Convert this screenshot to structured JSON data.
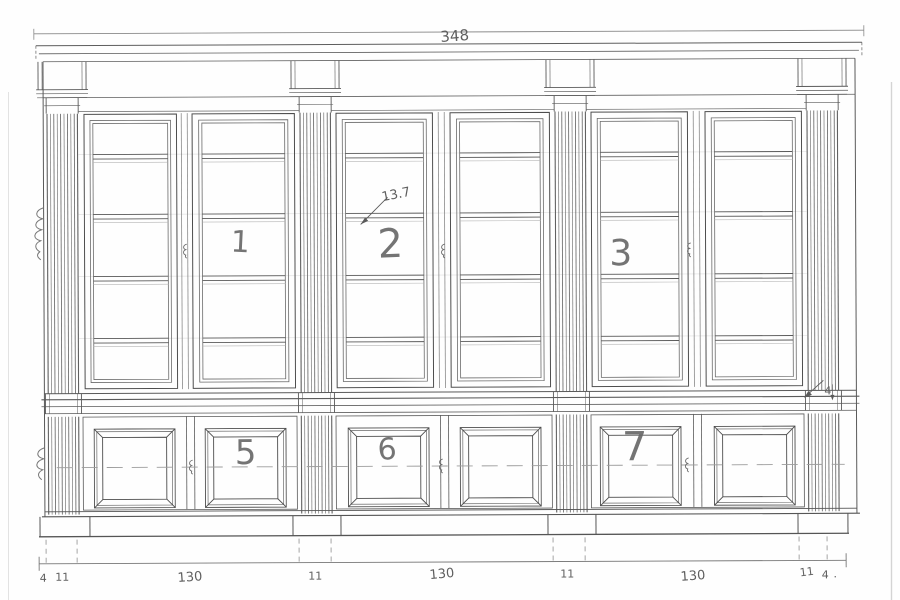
{
  "colors": {
    "line": "#4d4d4d",
    "mid": "#6a6a6a",
    "light": "#9a9a9a",
    "faint": "#cfcfcf",
    "paper": "#fefefe"
  },
  "labels": {
    "total_width": "348",
    "shelf_annotation": "13.7",
    "waist_annotation": "4",
    "trailing_dot": ".",
    "upper_doors": [
      "1",
      "2",
      "3"
    ],
    "lower_doors": [
      "5",
      "6",
      "7"
    ],
    "bottom_dims": [
      "4",
      "11",
      "130",
      "11",
      "130",
      "11",
      "130",
      "11",
      "4"
    ]
  }
}
